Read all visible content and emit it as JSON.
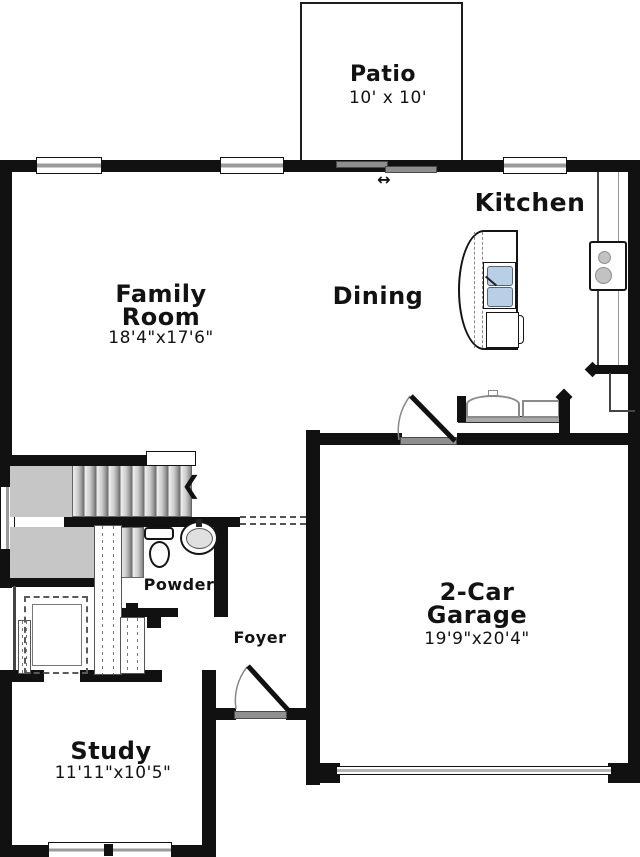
{
  "plan_type": "floor-plan",
  "rooms": {
    "patio": {
      "name": "Patio",
      "dims": "10' x 10'"
    },
    "kitchen": {
      "name": "Kitchen"
    },
    "dining": {
      "name": "Dining"
    },
    "family": {
      "name_1": "Family",
      "name_2": "Room",
      "dims": "18'4\"x17'6\""
    },
    "garage": {
      "name_1": "2-Car",
      "name_2": "Garage",
      "dims": "19'9\"x20'4\""
    },
    "powder": {
      "name": "Powder"
    },
    "foyer": {
      "name": "Foyer"
    },
    "study": {
      "name": "Study",
      "dims": "11'11\"x10'5\""
    }
  },
  "symbols": {
    "stairs_direction_arrow": "❮",
    "sliding_door_arrow": "↔"
  },
  "fixtures": [
    "staircase",
    "powder-toilet",
    "powder-sink",
    "kitchen-island",
    "island-sink",
    "dishwasher",
    "range",
    "refrigerator",
    "entry-bench",
    "sliding-patio-door",
    "front-door",
    "garage-entry-door",
    "garage-overhead-door",
    "under-stair-closet"
  ],
  "colors": {
    "wall": "#111111",
    "stair_fill": "#c6c6c6",
    "door_slab": "#8f8f8f",
    "sink_basin": "#b9cfe6",
    "burner": "#c2c2c2",
    "text": "#121212"
  }
}
